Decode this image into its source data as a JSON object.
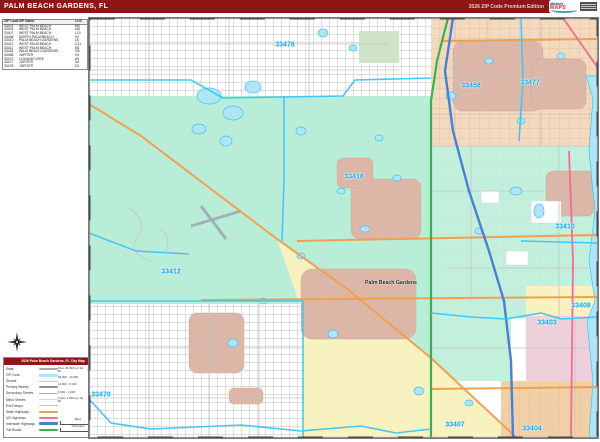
{
  "header": {
    "title": "PALM BEACH GARDENS, FL",
    "edition": "2026 ZIP Code Premium Edition",
    "logo": {
      "line1": "Market",
      "line2": "MAPS"
    }
  },
  "zip_table": {
    "headers": [
      "ZIP Code",
      "ZIP Name",
      "LOC"
    ],
    "rows": [
      {
        "code": "33403",
        "name": "WEST PALM BEACH",
        "loc": "M9"
      },
      {
        "code": "33404",
        "name": "WEST PALM BEACH",
        "loc": "M8"
      },
      {
        "code": "33407",
        "name": "WEST PALM BEACH",
        "loc": "L10"
      },
      {
        "code": "33408",
        "name": "NORTH PALM BEACH",
        "loc": "N7"
      },
      {
        "code": "33410",
        "name": "PALM BEACH GARDENS",
        "loc": "L6"
      },
      {
        "code": "33411",
        "name": "WEST PALM BEACH",
        "loc": "C11"
      },
      {
        "code": "33412",
        "name": "WEST PALM BEACH",
        "loc": "E8"
      },
      {
        "code": "33418",
        "name": "PALM BEACH GARDENS",
        "loc": "G5"
      },
      {
        "code": "33458",
        "name": "JUPITER",
        "loc": "H1"
      },
      {
        "code": "33470",
        "name": "LOXAHATCHEE",
        "loc": "A9"
      },
      {
        "code": "33477",
        "name": "JUPITER",
        "loc": "N2"
      },
      {
        "code": "33478",
        "name": "JUPITER",
        "loc": "D2"
      }
    ]
  },
  "map": {
    "city_label": "Palm Beach Gardens",
    "zip_labels": [
      {
        "code": "33478",
        "x": 196,
        "y": 27
      },
      {
        "code": "33458",
        "x": 382,
        "y": 68
      },
      {
        "code": "33477",
        "x": 441,
        "y": 65
      },
      {
        "code": "33418",
        "x": 265,
        "y": 159
      },
      {
        "code": "33410",
        "x": 476,
        "y": 209
      },
      {
        "code": "33412",
        "x": 82,
        "y": 254
      },
      {
        "code": "33408",
        "x": 492,
        "y": 288
      },
      {
        "code": "33403",
        "x": 458,
        "y": 305
      },
      {
        "code": "33470",
        "x": 12,
        "y": 377
      },
      {
        "code": "33407",
        "x": 366,
        "y": 407
      },
      {
        "code": "33404",
        "x": 443,
        "y": 411
      }
    ]
  },
  "legend": {
    "title": "2026 Palm Beach Gardens, FL City Map",
    "line_items": [
      {
        "label": "State",
        "color": "#a8a8a8",
        "h": 2
      },
      {
        "label": "ZIP Code",
        "color": "#a5e7fb",
        "h": 3
      },
      {
        "label": "Streets",
        "color": "#cccccc",
        "h": 1
      },
      {
        "label": "Primary Streets",
        "color": "#8f8f8f",
        "h": 2
      },
      {
        "label": "Secondary Streets",
        "color": "#ababab",
        "h": 1
      },
      {
        "label": "Minor Streets",
        "color": "#d6d6d6",
        "h": 1
      },
      {
        "label": "Exit Ramps",
        "color": "#c2c2c2",
        "h": 1
      },
      {
        "label": "State Highways",
        "color": "#f0a050",
        "h": 2
      },
      {
        "label": "US Highways",
        "color": "#f06a9a",
        "h": 2
      },
      {
        "label": "Interstate Highways",
        "color": "#4a7fd4",
        "h": 3
      },
      {
        "label": "Toll Roads",
        "color": "#35b44a",
        "h": 2
      }
    ],
    "density_items": [
      {
        "range": "Over 25,000 per Sq Mi",
        "sample": "City",
        "size": 7.5
      },
      {
        "range": "25,000 - 10,000",
        "sample": "City",
        "size": 6.2
      },
      {
        "range": "10,000 - 5,000",
        "sample": "City",
        "size": 5.2
      },
      {
        "range": "5,000 - 1,000",
        "sample": "City",
        "size": 4.2
      },
      {
        "range": "Under 1,000 per Sq Mi",
        "sample": "City",
        "size": 3.2
      }
    ],
    "scale": {
      "miles": "Miles",
      "kilometers": "Kilometers"
    }
  },
  "colors": {
    "header_bg": "#8e1616",
    "mint": "#b8eed7",
    "yellow": "#f7f2c0",
    "salmon": "#f3d9bd",
    "mauve": "#dcb6a6",
    "pink_zone": "#eed0da",
    "tan": "#f2d0a6",
    "water": "#aee6f8",
    "zip_boundary": "#3cc6f2",
    "interstate": "#4a7fd4",
    "turnpike": "#35b44a",
    "us_highway": "#f06a9a",
    "state_highway": "#f0a050",
    "zip_label": "#0ea2e6"
  }
}
